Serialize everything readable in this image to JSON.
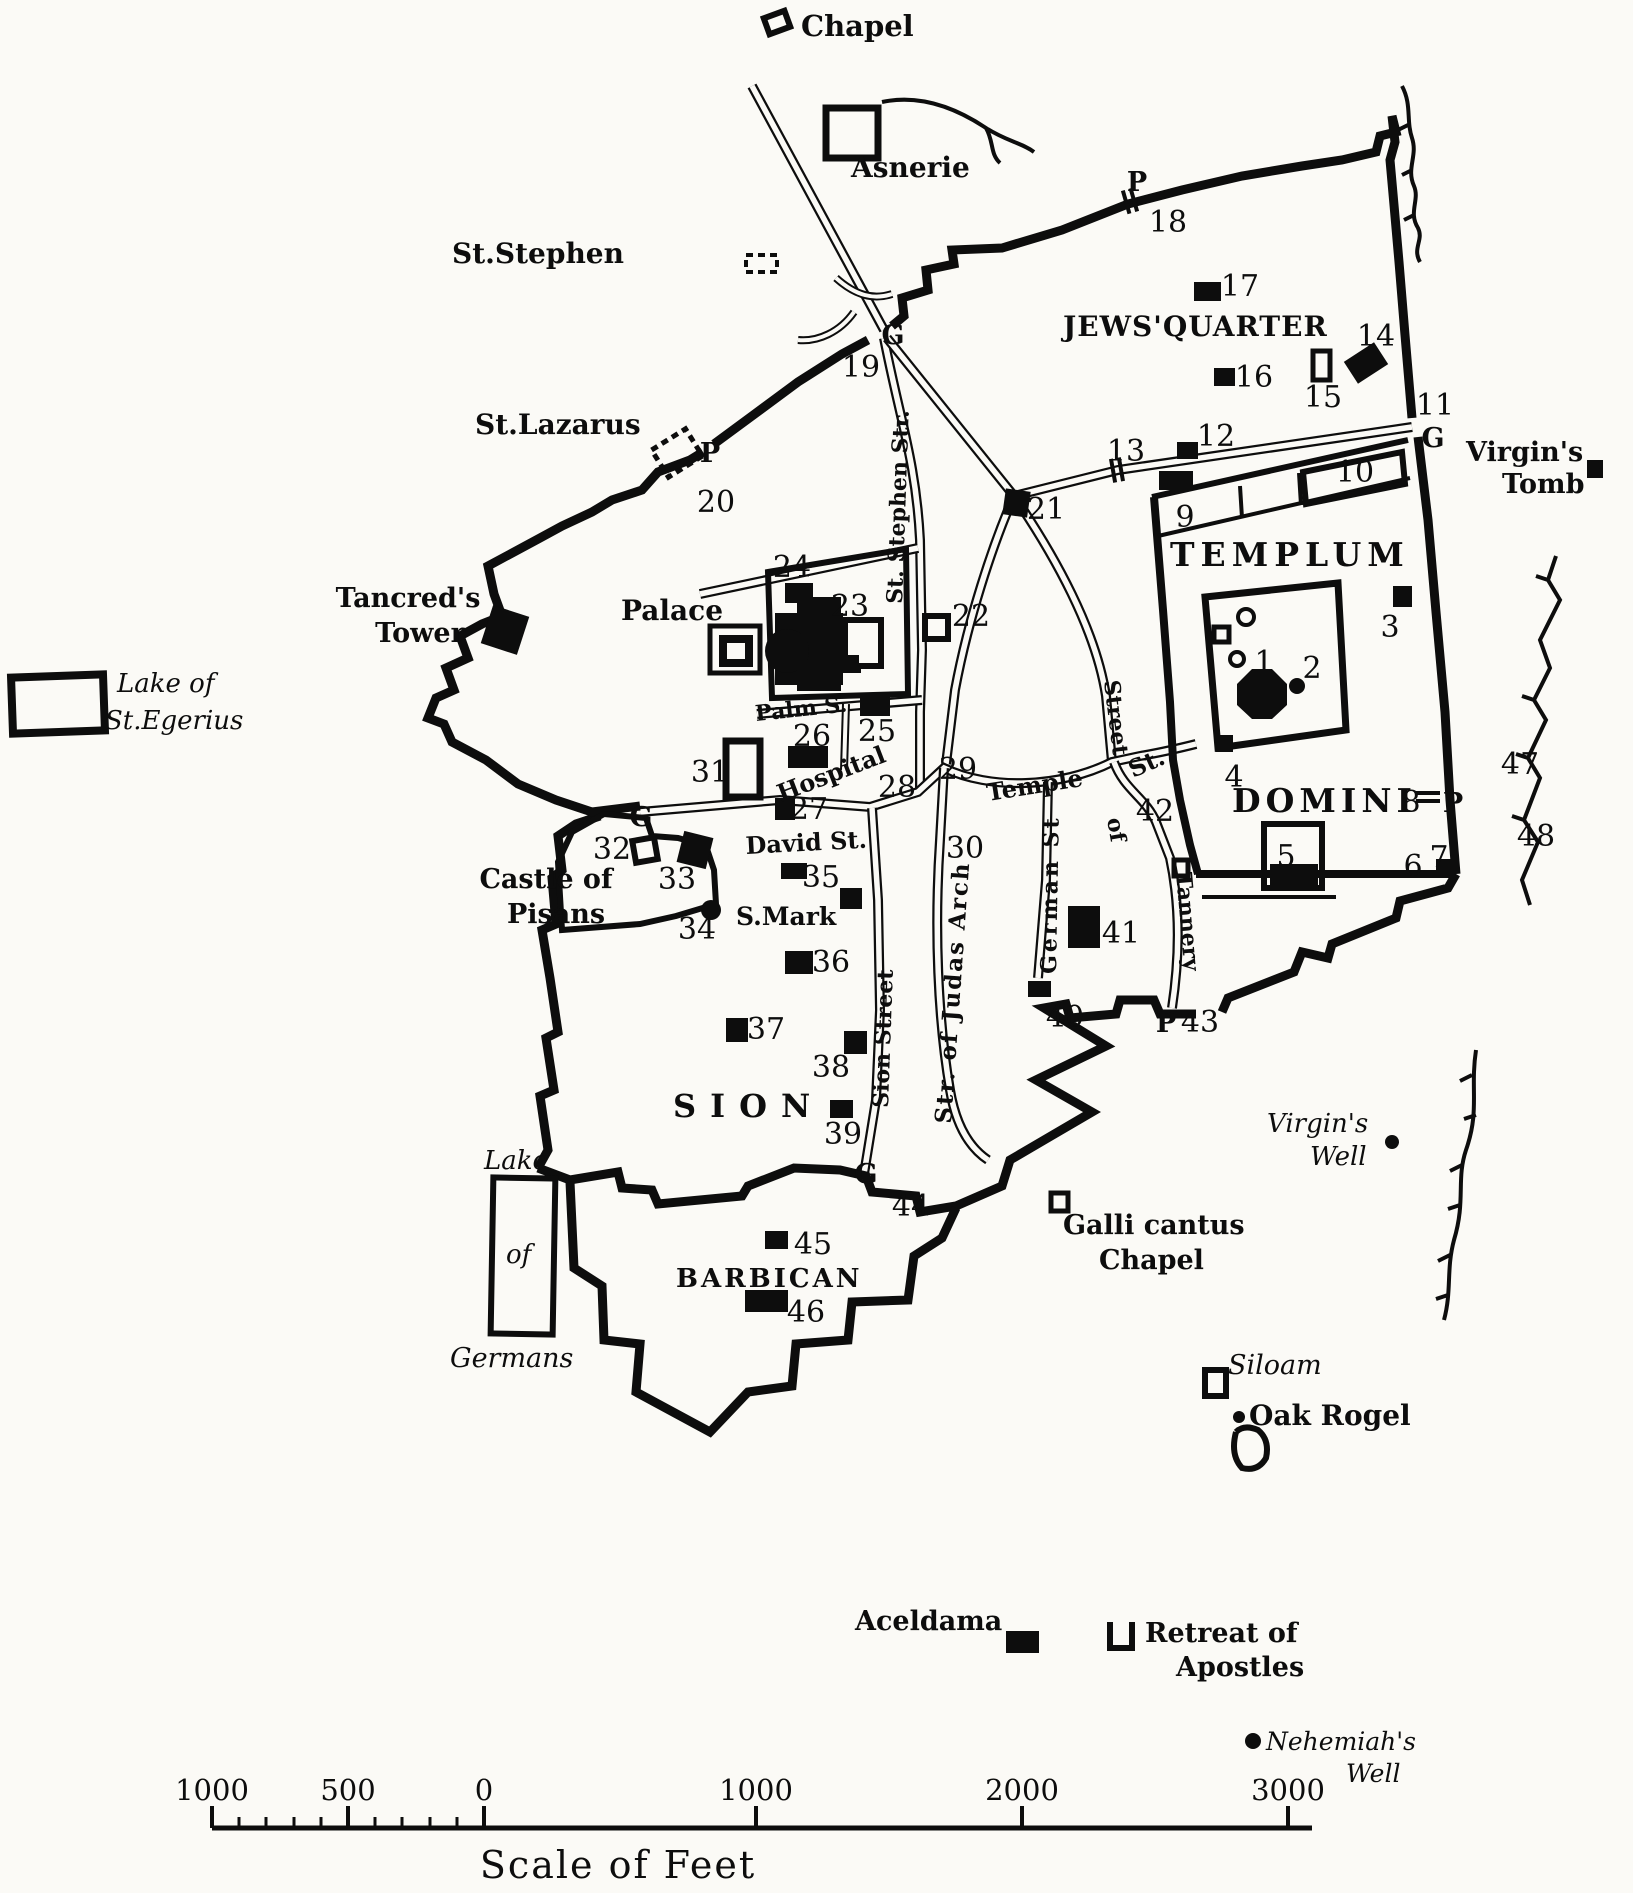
{
  "map": {
    "background": "#fbfaf6",
    "ink": "#0d0d0d",
    "labels": [
      {
        "id": "chapel",
        "t": "Chapel",
        "x": 801,
        "y": 36,
        "fs": 29,
        "b": 1
      },
      {
        "id": "asnerie",
        "t": "Asnerie",
        "x": 851,
        "y": 177,
        "fs": 28,
        "b": 1
      },
      {
        "id": "st-stephen",
        "t": "St.Stephen",
        "x": 452,
        "y": 263,
        "fs": 28,
        "b": 1
      },
      {
        "id": "st-lazarus",
        "t": "St.Lazarus",
        "x": 475,
        "y": 434,
        "fs": 28,
        "b": 1
      },
      {
        "id": "tancreds-tower-1",
        "t": "Tancred's",
        "x": 408,
        "y": 607,
        "fs": 27,
        "b": 1,
        "a": "middle"
      },
      {
        "id": "tancreds-tower-2",
        "t": "Tower",
        "x": 420,
        "y": 642,
        "fs": 27,
        "b": 1,
        "a": "middle"
      },
      {
        "id": "palace",
        "t": "Palace",
        "x": 672,
        "y": 620,
        "fs": 28,
        "b": 1,
        "a": "middle"
      },
      {
        "id": "lake-st-egerius-1",
        "t": "Lake of",
        "x": 117,
        "y": 692,
        "fs": 26,
        "it": 1
      },
      {
        "id": "lake-st-egerius-2",
        "t": "St.Egerius",
        "x": 105,
        "y": 729,
        "fs": 26,
        "it": 1
      },
      {
        "id": "castle-of-pisans-1",
        "t": "Castle of",
        "x": 546,
        "y": 888,
        "fs": 27,
        "b": 1,
        "a": "middle"
      },
      {
        "id": "castle-of-pisans-2",
        "t": "Pisans",
        "x": 556,
        "y": 923,
        "fs": 27,
        "b": 1,
        "a": "middle"
      },
      {
        "id": "jews-quarter",
        "t": "JEWS'QUARTER",
        "x": 1063,
        "y": 336,
        "fs": 28,
        "b": 1,
        "ls": 1
      },
      {
        "id": "templum",
        "t": "TEMPLUM",
        "x": 1170,
        "y": 566,
        "fs": 33,
        "b": 1,
        "ls": 6
      },
      {
        "id": "domini",
        "t": "DOMINI",
        "x": 1232,
        "y": 812,
        "fs": 33,
        "b": 1,
        "ls": 5
      },
      {
        "id": "virgins-tomb-1",
        "t": "Virgin's",
        "x": 1466,
        "y": 461,
        "fs": 27,
        "b": 1
      },
      {
        "id": "virgins-tomb-2",
        "t": "Tomb",
        "x": 1502,
        "y": 493,
        "fs": 27,
        "b": 1
      },
      {
        "id": "sion",
        "t": "SION",
        "x": 673,
        "y": 1117,
        "fs": 32,
        "b": 1,
        "ls": 14
      },
      {
        "id": "barbican",
        "t": "BARBICAN",
        "x": 676,
        "y": 1287,
        "fs": 26,
        "b": 1,
        "ls": 3
      },
      {
        "id": "virgins-well-1",
        "t": "Virgin's",
        "x": 1267,
        "y": 1132,
        "fs": 26,
        "it": 1
      },
      {
        "id": "virgins-well-2",
        "t": "Well",
        "x": 1310,
        "y": 1165,
        "fs": 26,
        "it": 1
      },
      {
        "id": "galli-cantus-1",
        "t": "Galli cantus",
        "x": 1063,
        "y": 1234,
        "fs": 27,
        "b": 1
      },
      {
        "id": "galli-cantus-2",
        "t": "Chapel",
        "x": 1099,
        "y": 1269,
        "fs": 27,
        "b": 1
      },
      {
        "id": "siloam",
        "t": "Siloam",
        "x": 1228,
        "y": 1374,
        "fs": 27,
        "it": 1
      },
      {
        "id": "oak-rogel",
        "t": "Oak Rogel",
        "x": 1249,
        "y": 1425,
        "fs": 28,
        "b": 1
      },
      {
        "id": "aceldama",
        "t": "Aceldama",
        "x": 855,
        "y": 1630,
        "fs": 27,
        "b": 1
      },
      {
        "id": "retreat-1",
        "t": "Retreat of",
        "x": 1145,
        "y": 1642,
        "fs": 27,
        "b": 1
      },
      {
        "id": "retreat-2",
        "t": "Apostles",
        "x": 1176,
        "y": 1676,
        "fs": 27,
        "b": 1
      },
      {
        "id": "nehemiahs-well-1",
        "t": "Nehemiah's",
        "x": 1266,
        "y": 1750,
        "fs": 25,
        "it": 1
      },
      {
        "id": "nehemiahs-well-2",
        "t": "Well",
        "x": 1346,
        "y": 1782,
        "fs": 25,
        "it": 1
      },
      {
        "id": "lake-germans-1",
        "t": "Lake",
        "x": 484,
        "y": 1169,
        "fs": 26,
        "it": 1
      },
      {
        "id": "lake-germans-2",
        "t": "of",
        "x": 506,
        "y": 1263,
        "fs": 26,
        "it": 1
      },
      {
        "id": "lake-germans-3",
        "t": "Germans",
        "x": 450,
        "y": 1367,
        "fs": 27,
        "it": 1
      },
      {
        "id": "david-st",
        "t": "David St.",
        "x": 746,
        "y": 854,
        "fs": 24,
        "b": 1,
        "r": -3
      },
      {
        "id": "s-mark",
        "t": "S.Mark",
        "x": 736,
        "y": 925,
        "fs": 25,
        "b": 1
      },
      {
        "id": "palm-s",
        "t": "Palm S.",
        "x": 756,
        "y": 721,
        "fs": 22,
        "b": 1,
        "r": -6
      },
      {
        "id": "hospital",
        "t": "Hospital",
        "x": 781,
        "y": 802,
        "fs": 24,
        "b": 1,
        "r": -21
      },
      {
        "id": "st-stephen-str",
        "t": "St. Stephen Str.",
        "x": 902,
        "y": 604,
        "fs": 22,
        "b": 1,
        "r": -88
      },
      {
        "id": "temple-st-1",
        "t": "Temple",
        "x": 988,
        "y": 801,
        "fs": 24,
        "b": 1,
        "r": -9
      },
      {
        "id": "temple-st-2",
        "t": "St.",
        "x": 1133,
        "y": 778,
        "fs": 24,
        "b": 1,
        "r": -24
      },
      {
        "id": "street-of-tannery-1",
        "t": "Street",
        "x": 1104,
        "y": 681,
        "fs": 22,
        "b": 1,
        "r": 83
      },
      {
        "id": "street-of-tannery-2",
        "t": "of",
        "x": 1107,
        "y": 819,
        "fs": 22,
        "b": 1,
        "r": 80
      },
      {
        "id": "street-of-tannery-3",
        "t": "Tannery",
        "x": 1176,
        "y": 873,
        "fs": 22,
        "b": 1,
        "r": 85
      },
      {
        "id": "sion-street",
        "t": "Sion Street",
        "x": 888,
        "y": 1108,
        "fs": 22,
        "b": 1,
        "r": -88
      },
      {
        "id": "judas-arch",
        "t": "Str. of Judas Arch",
        "x": 951,
        "y": 1124,
        "fs": 23,
        "b": 1,
        "r": -86,
        "ls": 2
      },
      {
        "id": "german-st",
        "t": "German St",
        "x": 1056,
        "y": 974,
        "fs": 22,
        "b": 1,
        "r": -89,
        "ls": 3
      }
    ],
    "numbers": [
      {
        "t": "1",
        "x": 1264,
        "y": 672
      },
      {
        "t": "2",
        "x": 1312,
        "y": 678
      },
      {
        "t": "3",
        "x": 1390,
        "y": 637
      },
      {
        "t": "4",
        "x": 1234,
        "y": 787
      },
      {
        "t": "5",
        "x": 1286,
        "y": 866
      },
      {
        "t": "6",
        "x": 1413,
        "y": 876
      },
      {
        "t": "7",
        "x": 1439,
        "y": 867
      },
      {
        "t": "8",
        "x": 1411,
        "y": 812
      },
      {
        "t": "9",
        "x": 1185,
        "y": 527
      },
      {
        "t": "10",
        "x": 1355,
        "y": 482
      },
      {
        "t": "11",
        "x": 1435,
        "y": 415
      },
      {
        "t": "12",
        "x": 1216,
        "y": 446
      },
      {
        "t": "13",
        "x": 1126,
        "y": 461
      },
      {
        "t": "14",
        "x": 1376,
        "y": 346
      },
      {
        "t": "15",
        "x": 1323,
        "y": 407
      },
      {
        "t": "16",
        "x": 1254,
        "y": 387
      },
      {
        "t": "17",
        "x": 1240,
        "y": 296
      },
      {
        "t": "18",
        "x": 1168,
        "y": 232
      },
      {
        "t": "19",
        "x": 861,
        "y": 377
      },
      {
        "t": "20",
        "x": 716,
        "y": 512
      },
      {
        "t": "21",
        "x": 1046,
        "y": 519
      },
      {
        "t": "22",
        "x": 971,
        "y": 626
      },
      {
        "t": "23",
        "x": 850,
        "y": 616
      },
      {
        "t": "24",
        "x": 792,
        "y": 577
      },
      {
        "t": "25",
        "x": 877,
        "y": 741
      },
      {
        "t": "26",
        "x": 812,
        "y": 746
      },
      {
        "t": "27",
        "x": 809,
        "y": 819
      },
      {
        "t": "28",
        "x": 897,
        "y": 797
      },
      {
        "t": "29",
        "x": 958,
        "y": 779
      },
      {
        "t": "30",
        "x": 965,
        "y": 858
      },
      {
        "t": "31",
        "x": 710,
        "y": 782
      },
      {
        "t": "32",
        "x": 612,
        "y": 859
      },
      {
        "t": "33",
        "x": 677,
        "y": 889
      },
      {
        "t": "34",
        "x": 697,
        "y": 939
      },
      {
        "t": "35",
        "x": 821,
        "y": 887
      },
      {
        "t": "36",
        "x": 831,
        "y": 972
      },
      {
        "t": "37",
        "x": 766,
        "y": 1039
      },
      {
        "t": "38",
        "x": 831,
        "y": 1077
      },
      {
        "t": "39",
        "x": 843,
        "y": 1144
      },
      {
        "t": "40",
        "x": 1065,
        "y": 1027
      },
      {
        "t": "41",
        "x": 1121,
        "y": 943
      },
      {
        "t": "42",
        "x": 1155,
        "y": 821
      },
      {
        "t": "43",
        "x": 1200,
        "y": 1032
      },
      {
        "t": "44",
        "x": 911,
        "y": 1216
      },
      {
        "t": "45",
        "x": 813,
        "y": 1254
      },
      {
        "t": "46",
        "x": 806,
        "y": 1322
      },
      {
        "t": "47",
        "x": 1520,
        "y": 774
      },
      {
        "t": "48",
        "x": 1536,
        "y": 846
      }
    ],
    "gates": [
      {
        "t": "G",
        "x": 893,
        "y": 344
      },
      {
        "t": "G",
        "x": 1433,
        "y": 447
      },
      {
        "t": "G",
        "x": 641,
        "y": 826
      },
      {
        "t": "G",
        "x": 866,
        "y": 1183
      },
      {
        "t": "P",
        "x": 1137,
        "y": 191
      },
      {
        "t": "P",
        "x": 710,
        "y": 462
      },
      {
        "t": "P",
        "x": 1453,
        "y": 812
      },
      {
        "t": "P",
        "x": 1166,
        "y": 1032
      }
    ],
    "hash_marks": [
      {
        "x": 1130,
        "y": 201,
        "r": 74
      },
      {
        "x": 1117,
        "y": 470,
        "r": 80
      },
      {
        "x": 1428,
        "y": 797,
        "r": 0
      }
    ],
    "markers": [
      {
        "n": "chapel-icon",
        "t": "open",
        "x": 766,
        "y": 14,
        "w": 22,
        "h": 17,
        "r": -20,
        "s": 6
      },
      {
        "n": "asnerie-icon",
        "t": "open",
        "x": 826,
        "y": 108,
        "w": 52,
        "h": 50,
        "s": 7
      },
      {
        "n": "st-stephen-icon",
        "t": "dashed",
        "x": 746,
        "y": 255,
        "w": 31,
        "h": 17,
        "s": 4
      },
      {
        "n": "st-lazarus-icon",
        "t": "dashed",
        "x": 657,
        "y": 437,
        "w": 40,
        "h": 32,
        "r": -32,
        "s": 5
      },
      {
        "n": "tancreds-tower-icon",
        "t": "diamond",
        "x": 486,
        "y": 610,
        "w": 38,
        "h": 40,
        "r": 18
      },
      {
        "n": "palace-outer-icon",
        "t": "open",
        "x": 710,
        "y": 626,
        "w": 50,
        "h": 47,
        "s": 5
      },
      {
        "n": "palace-inner-icon",
        "t": "open",
        "x": 723,
        "y": 639,
        "w": 26,
        "h": 24,
        "s": 8
      },
      {
        "n": "lake-st-egerius-icon",
        "t": "open",
        "x": 12,
        "y": 676,
        "w": 92,
        "h": 56,
        "r": -2,
        "s": 8
      },
      {
        "n": "lake-germans-icon",
        "t": "open",
        "x": 492,
        "y": 1178,
        "w": 62,
        "h": 156,
        "r": 1,
        "s": 6
      },
      {
        "n": "site-3-block",
        "t": "block",
        "x": 1393,
        "y": 586,
        "w": 19,
        "h": 21
      },
      {
        "n": "site-4-block",
        "t": "block",
        "x": 1216,
        "y": 735,
        "w": 17,
        "h": 17
      },
      {
        "n": "site-6-block",
        "t": "block",
        "x": 1436,
        "y": 859,
        "w": 20,
        "h": 19
      },
      {
        "n": "site-9-block",
        "t": "block",
        "x": 1159,
        "y": 471,
        "w": 34,
        "h": 19
      },
      {
        "n": "site-12-block",
        "t": "block",
        "x": 1177,
        "y": 442,
        "w": 21,
        "h": 17
      },
      {
        "n": "site-14-block",
        "t": "diamond",
        "x": 1348,
        "y": 350,
        "w": 36,
        "h": 26,
        "r": -33
      },
      {
        "n": "site-15-icon",
        "t": "open",
        "x": 1313,
        "y": 351,
        "w": 17,
        "h": 29,
        "s": 5
      },
      {
        "n": "site-16-block",
        "t": "block",
        "x": 1214,
        "y": 368,
        "w": 21,
        "h": 18
      },
      {
        "n": "site-17-block",
        "t": "block",
        "x": 1194,
        "y": 282,
        "w": 27,
        "h": 19
      },
      {
        "n": "site-21-block",
        "t": "block",
        "x": 1004,
        "y": 490,
        "w": 25,
        "h": 26,
        "r": 8
      },
      {
        "n": "site-22-icon",
        "t": "open",
        "x": 925,
        "y": 616,
        "w": 23,
        "h": 23,
        "s": 6
      },
      {
        "n": "site-24-block",
        "t": "block",
        "x": 785,
        "y": 583,
        "w": 28,
        "h": 20
      },
      {
        "n": "site-25-block",
        "t": "block",
        "x": 860,
        "y": 696,
        "w": 30,
        "h": 20
      },
      {
        "n": "site-26-block",
        "t": "block",
        "x": 788,
        "y": 746,
        "w": 40,
        "h": 22
      },
      {
        "n": "site-27-block",
        "t": "block",
        "x": 775,
        "y": 798,
        "w": 20,
        "h": 22
      },
      {
        "n": "site-31-icon",
        "t": "open",
        "x": 726,
        "y": 741,
        "w": 34,
        "h": 56,
        "s": 7
      },
      {
        "n": "site-32-icon",
        "t": "open",
        "x": 634,
        "y": 839,
        "w": 22,
        "h": 22,
        "r": -10,
        "s": 6
      },
      {
        "n": "site-33-block",
        "t": "block",
        "x": 680,
        "y": 834,
        "w": 30,
        "h": 32,
        "r": 14
      },
      {
        "n": "site-34-dot",
        "t": "dot",
        "x": 711,
        "y": 910,
        "rad": 10
      },
      {
        "n": "site-35-block",
        "t": "block",
        "x": 781,
        "y": 863,
        "w": 26,
        "h": 16
      },
      {
        "n": "s-mark-block",
        "t": "block",
        "x": 840,
        "y": 888,
        "w": 22,
        "h": 21
      },
      {
        "n": "site-36-block",
        "t": "block",
        "x": 785,
        "y": 951,
        "w": 28,
        "h": 23
      },
      {
        "n": "site-37-block",
        "t": "block",
        "x": 726,
        "y": 1018,
        "w": 22,
        "h": 24
      },
      {
        "n": "site-38-block",
        "t": "block",
        "x": 844,
        "y": 1031,
        "w": 23,
        "h": 23
      },
      {
        "n": "site-39-block",
        "t": "block",
        "x": 830,
        "y": 1100,
        "w": 23,
        "h": 18
      },
      {
        "n": "site-40-block",
        "t": "block",
        "x": 1028,
        "y": 981,
        "w": 23,
        "h": 16
      },
      {
        "n": "site-41-block",
        "t": "block",
        "x": 1068,
        "y": 906,
        "w": 32,
        "h": 42
      },
      {
        "n": "site-42-icon",
        "t": "open",
        "x": 1174,
        "y": 860,
        "w": 14,
        "h": 16,
        "s": 5
      },
      {
        "n": "site-45-block",
        "t": "block",
        "x": 765,
        "y": 1231,
        "w": 23,
        "h": 18
      },
      {
        "n": "site-46-block",
        "t": "block",
        "x": 745,
        "y": 1290,
        "w": 43,
        "h": 22
      },
      {
        "n": "aceldama-block",
        "t": "block",
        "x": 1006,
        "y": 1631,
        "w": 33,
        "h": 22
      },
      {
        "n": "virgins-tomb-icon",
        "t": "block",
        "x": 1587,
        "y": 460,
        "w": 16,
        "h": 18
      },
      {
        "n": "galli-cantus-icon",
        "t": "open",
        "x": 1051,
        "y": 1193,
        "w": 17,
        "h": 18,
        "s": 5
      },
      {
        "n": "siloam-icon",
        "t": "open",
        "x": 1205,
        "y": 1370,
        "w": 21,
        "h": 26,
        "s": 6
      },
      {
        "n": "oak-rogel-dot",
        "t": "dot",
        "x": 1239,
        "y": 1417,
        "rad": 6
      },
      {
        "n": "virgins-well-dot",
        "t": "dot",
        "x": 1392,
        "y": 1142,
        "rad": 7
      },
      {
        "n": "nehemiahs-well-dot",
        "t": "dot",
        "x": 1253,
        "y": 1741,
        "rad": 8
      },
      {
        "n": "retreat-of-apostles-icon",
        "t": "u",
        "x": 1121,
        "y": 1635,
        "w": 22,
        "h": 26
      },
      {
        "n": "temple-circle-a",
        "t": "ring",
        "x": 1246,
        "y": 617,
        "rad": 8
      },
      {
        "n": "temple-circle-b",
        "t": "ring",
        "x": 1237,
        "y": 659,
        "rad": 7
      },
      {
        "n": "temple-square",
        "t": "open",
        "x": 1214,
        "y": 627,
        "w": 15,
        "h": 15,
        "s": 5
      },
      {
        "n": "site-2-dot",
        "t": "dot",
        "x": 1297,
        "y": 686,
        "rad": 8
      },
      {
        "n": "site-5-icon",
        "t": "open",
        "x": 1264,
        "y": 824,
        "w": 58,
        "h": 64,
        "s": 6
      },
      {
        "n": "site-5-band",
        "t": "block",
        "x": 1270,
        "y": 864,
        "w": 48,
        "h": 25
      }
    ],
    "scale": {
      "caption": "Scale of Feet",
      "bar": {
        "x1": 212,
        "x2": 1312,
        "y": 1828
      },
      "major_ticks": [
        {
          "t": "1000",
          "x": 212
        },
        {
          "t": "500",
          "x": 348
        },
        {
          "t": "0",
          "x": 484
        },
        {
          "t": "1000",
          "x": 756
        },
        {
          "t": "2000",
          "x": 1022
        },
        {
          "t": "3000",
          "x": 1288
        }
      ],
      "minor_ticks_x": [
        239,
        266,
        294,
        321,
        375,
        402,
        430,
        457
      ]
    }
  }
}
